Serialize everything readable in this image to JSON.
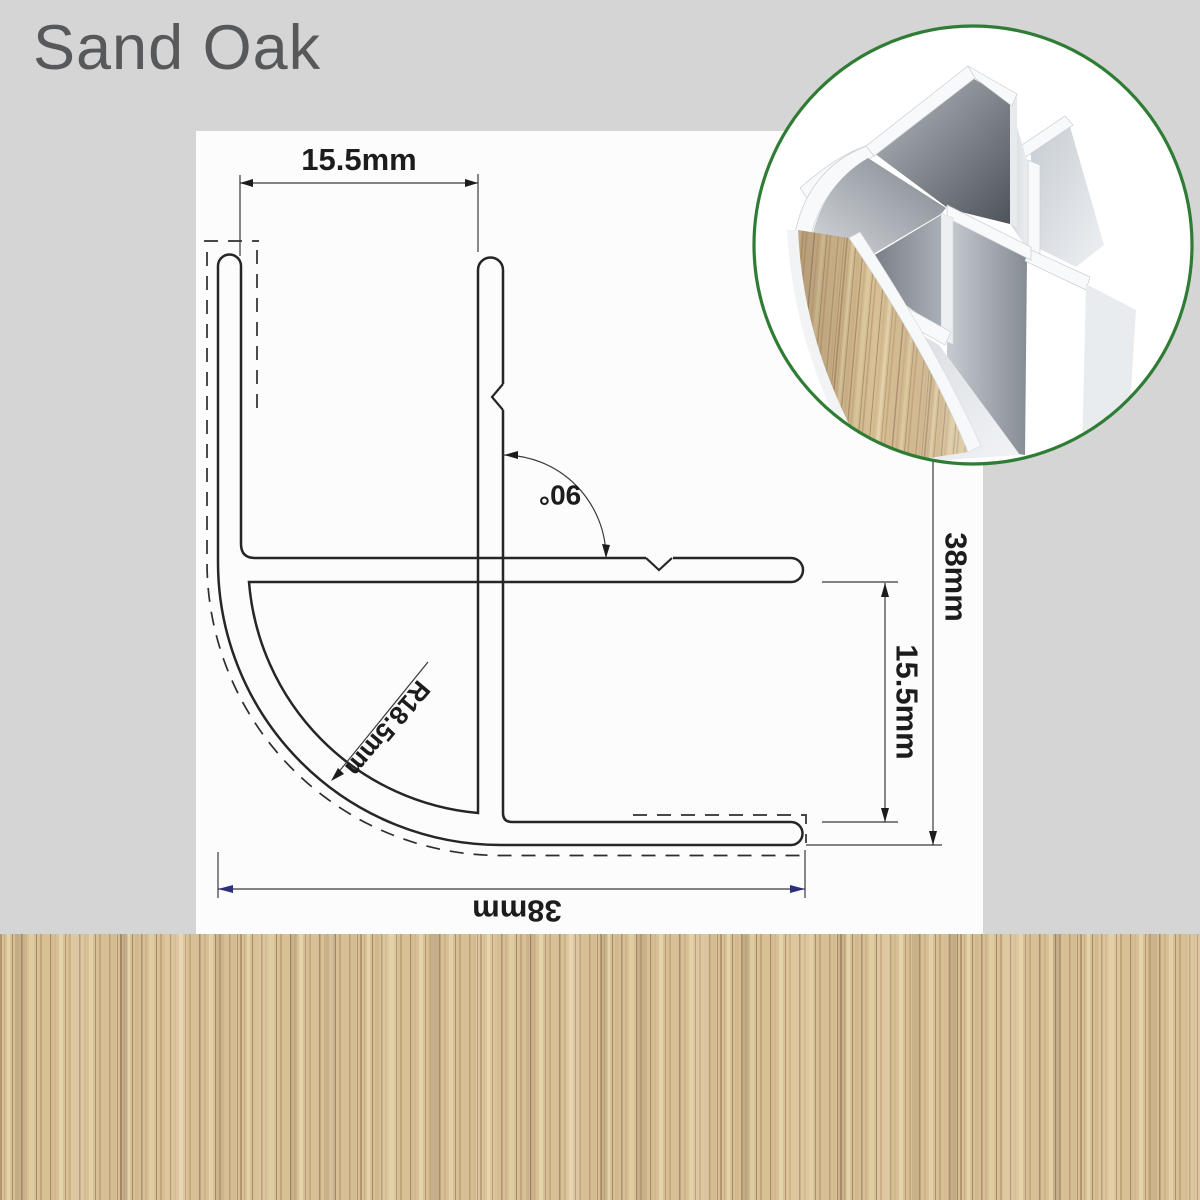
{
  "title": "Sand Oak",
  "dimensions": {
    "top_width": "15.5mm",
    "bottom_width": "38mm",
    "right_height": "38mm",
    "right_slot": "15.5mm",
    "corner_radius": "R18.5mm",
    "angle": "90°"
  },
  "colors": {
    "background": "#d5d5d6",
    "panel": "#fcfcfc",
    "line": "#262626",
    "dimension_arrow_navy": "#2c2f7c",
    "inset_border_green": "#2f7c34",
    "wood_base": "#d8c096"
  }
}
